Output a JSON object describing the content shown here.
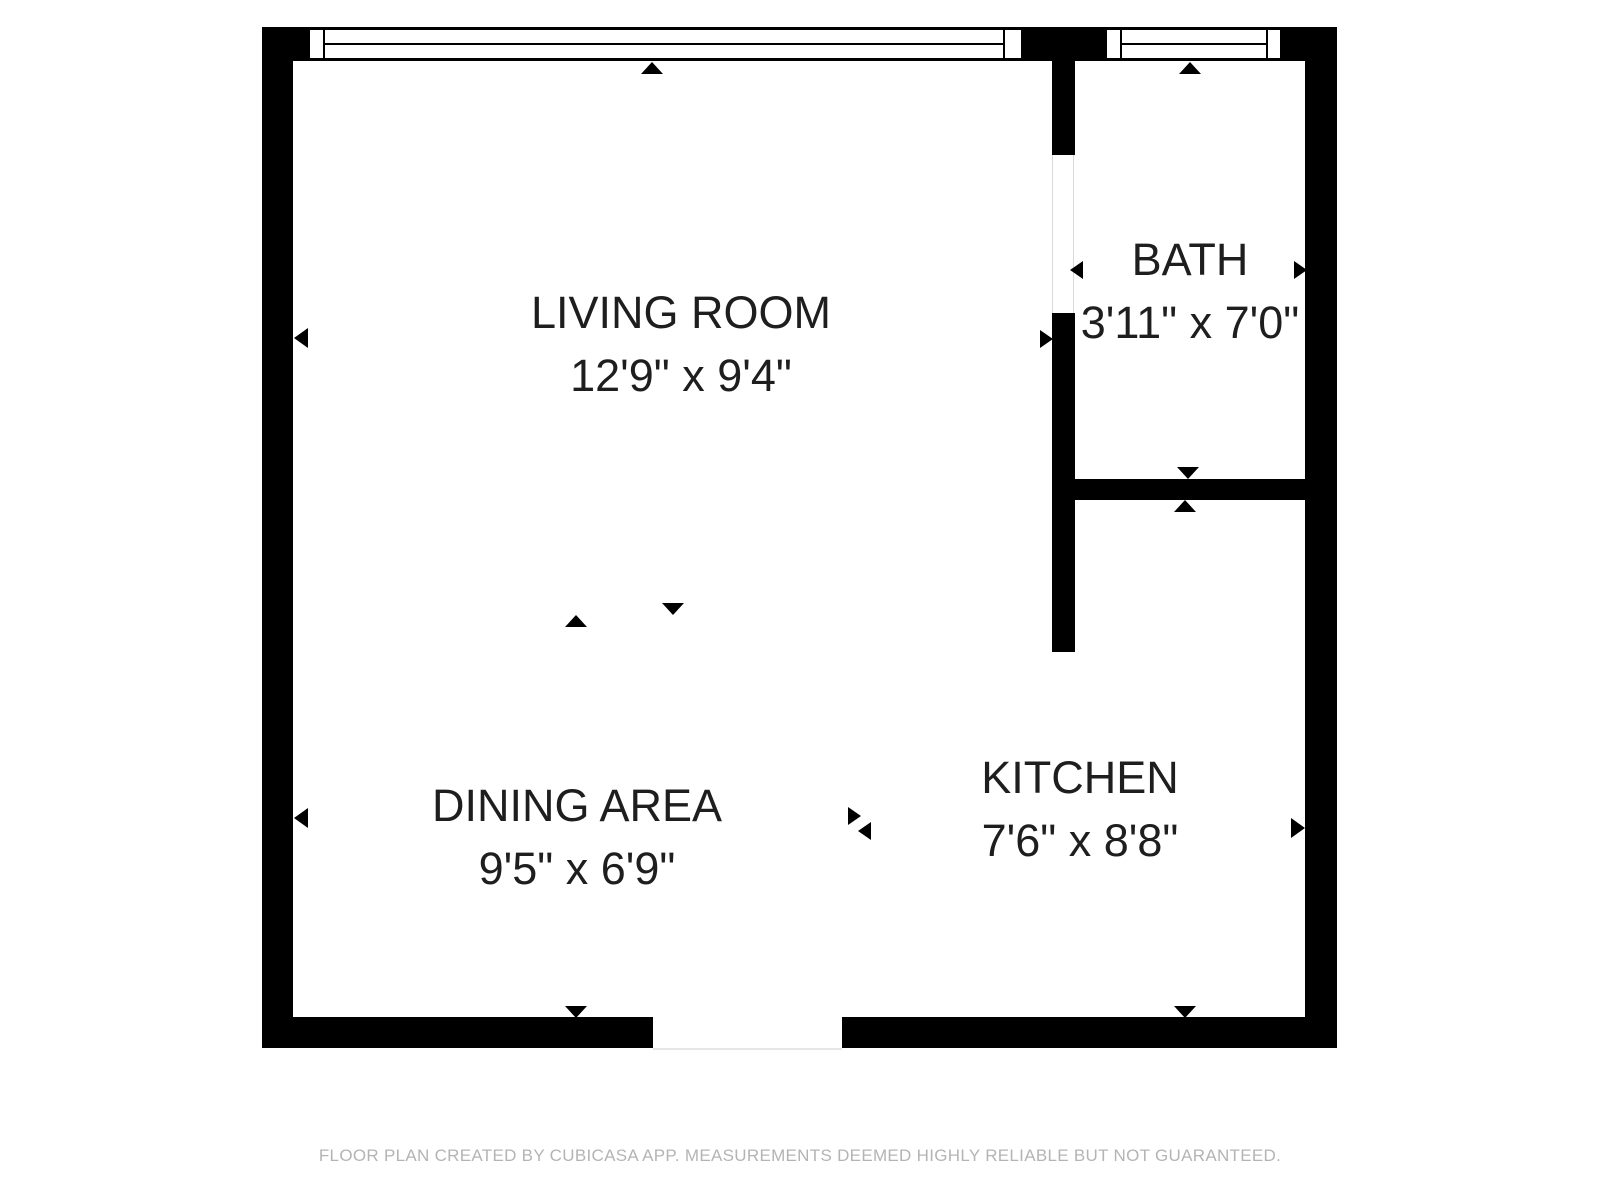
{
  "floor_plan": {
    "rooms": [
      {
        "name": "LIVING ROOM",
        "dimensions": "12'9\" x 9'4\""
      },
      {
        "name": "BATH",
        "dimensions": "3'11\" x 7'0\""
      },
      {
        "name": "DINING AREA",
        "dimensions": "9'5\" x 6'9\""
      },
      {
        "name": "KITCHEN",
        "dimensions": "7'6\" x 8'8\""
      }
    ],
    "markers": [
      {
        "name": "window-marker-living",
        "direction": "up"
      },
      {
        "name": "window-marker-bath",
        "direction": "up"
      },
      {
        "name": "bath-door-marker-inner-left",
        "direction": "left"
      },
      {
        "name": "bath-door-marker-inner-right",
        "direction": "right"
      },
      {
        "name": "bath-door-marker-outer",
        "direction": "right"
      },
      {
        "name": "bath-kitchen-wall-marker-top",
        "direction": "down"
      },
      {
        "name": "bath-kitchen-wall-marker-bottom",
        "direction": "up"
      },
      {
        "name": "living-dining-boundary-marker-up",
        "direction": "up"
      },
      {
        "name": "living-dining-boundary-marker-down",
        "direction": "down"
      },
      {
        "name": "dining-kitchen-boundary-marker-right",
        "direction": "right"
      },
      {
        "name": "dining-kitchen-boundary-marker-left",
        "direction": "left"
      },
      {
        "name": "left-wall-marker-living",
        "direction": "left"
      },
      {
        "name": "left-wall-marker-dining",
        "direction": "left"
      },
      {
        "name": "right-wall-marker-kitchen",
        "direction": "right"
      },
      {
        "name": "bottom-wall-marker-dining",
        "direction": "down"
      },
      {
        "name": "bottom-wall-marker-kitchen",
        "direction": "down"
      }
    ],
    "footer": "FLOOR PLAN CREATED BY CUBICASA APP. MEASUREMENTS DEEMED HIGHLY RELIABLE BUT NOT GUARANTEED.",
    "colors": {
      "wall": "#000000",
      "room_text": "#1e1e1e",
      "footer_text": "#b4b4b4",
      "background": "#ffffff"
    }
  }
}
